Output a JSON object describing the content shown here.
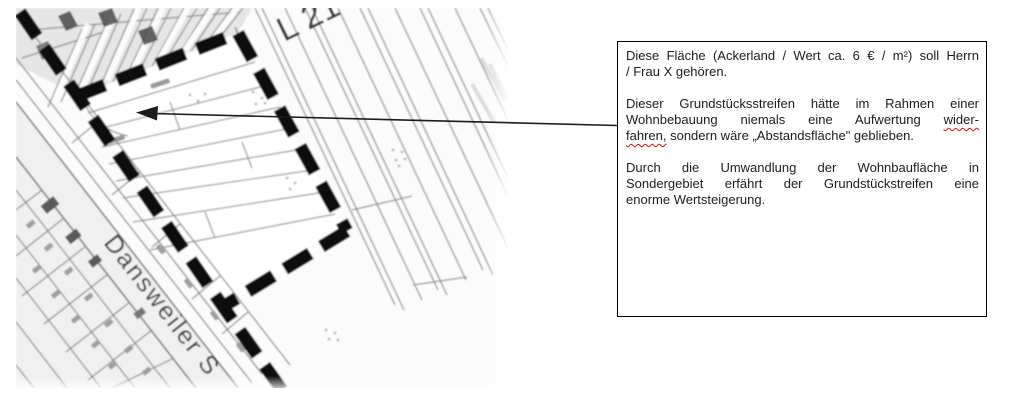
{
  "map": {
    "street_label": "Dansweiler S",
    "road_label": "L 21",
    "boundary_color": "#0d0d0d",
    "parcel_line_color": "#8a8a8a",
    "street_edge_color": "#777777"
  },
  "callout": {
    "arrow_color": "#1c1c1c",
    "box": {
      "border_color": "#000000",
      "background": "#ffffff",
      "paragraphs": [
        {
          "lines": [
            {
              "justify": true,
              "segments": [
                {
                  "text": "Diese Fläche (Ackerland / Wert ca. 6 € / m²) soll Herrn"
                }
              ]
            },
            {
              "justify": false,
              "segments": [
                {
                  "text": "/ Frau X gehören."
                }
              ]
            }
          ]
        },
        {
          "lines": [
            {
              "justify": true,
              "segments": [
                {
                  "text": "Dieser Grundstücksstreifen hätte im Rahmen einer"
                }
              ]
            },
            {
              "justify": true,
              "segments": [
                {
                  "text": "Wohnbebauung niemals eine Aufwertung "
                },
                {
                  "text": "wider-",
                  "misspelled": true
                }
              ]
            },
            {
              "justify": false,
              "segments": [
                {
                  "text": "fahren,",
                  "misspelled": true
                },
                {
                  "text": " sondern wäre „Abstandsfläche\" geblieben."
                }
              ]
            }
          ]
        },
        {
          "lines": [
            {
              "justify": true,
              "segments": [
                {
                  "text": "Durch die Umwandlung der Wohnbaufläche in"
                }
              ]
            },
            {
              "justify": true,
              "segments": [
                {
                  "text": "Sondergebiet  erfährt der Grundstückstreifen eine"
                }
              ]
            },
            {
              "justify": false,
              "segments": [
                {
                  "text": "enorme Wertsteigerung."
                }
              ]
            }
          ]
        }
      ]
    }
  }
}
